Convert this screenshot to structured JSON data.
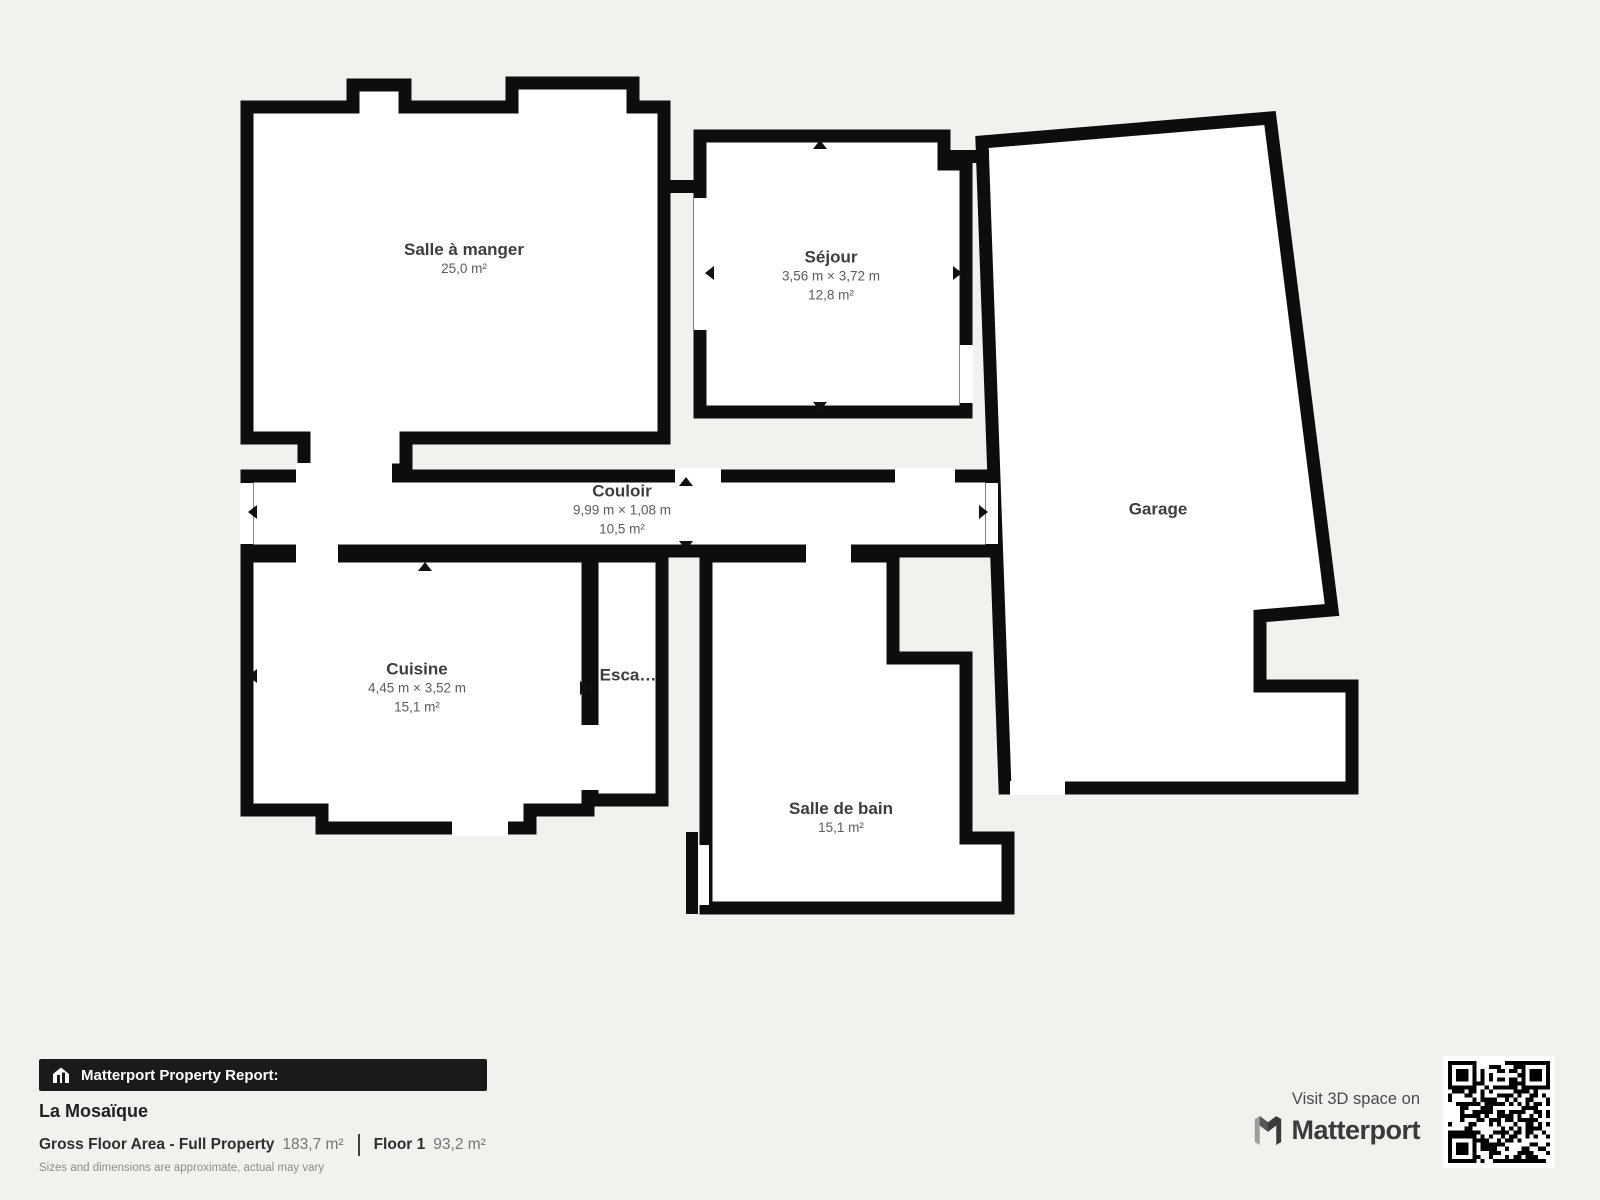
{
  "floorplan": {
    "rooms": [
      {
        "id": "salle-a-manger",
        "name": "Salle à manger",
        "area": "25,0 m²"
      },
      {
        "id": "sejour",
        "name": "Séjour",
        "dims": "3,56 m × 3,72 m",
        "area": "12,8 m²"
      },
      {
        "id": "couloir",
        "name": "Couloir",
        "dims": "9,99 m × 1,08 m",
        "area": "10,5 m²"
      },
      {
        "id": "cuisine",
        "name": "Cuisine",
        "dims": "4,45 m × 3,52 m",
        "area": "15,1 m²"
      },
      {
        "id": "escalier",
        "name": "Esca…"
      },
      {
        "id": "salle-de-bain",
        "name": "Salle de bain",
        "area": "15,1 m²"
      },
      {
        "id": "garage",
        "name": "Garage"
      }
    ]
  },
  "footer": {
    "report_label": "Matterport Property Report:",
    "property_name": "La Mosaïque",
    "gfa_label": "Gross Floor Area - Full Property",
    "gfa_value": "183,7 m²",
    "floor_label": "Floor 1",
    "floor_value": "93,2 m²",
    "disclaimer": "Sizes and dimensions are approximate, actual may vary",
    "visit_label": "Visit 3D space on",
    "brand": "Matterport"
  },
  "colors": {
    "background": "#f2f1ee",
    "wall": "#0d0d0d",
    "room_fill": "#ffffff",
    "banner_bg": "#1a1a1a"
  }
}
